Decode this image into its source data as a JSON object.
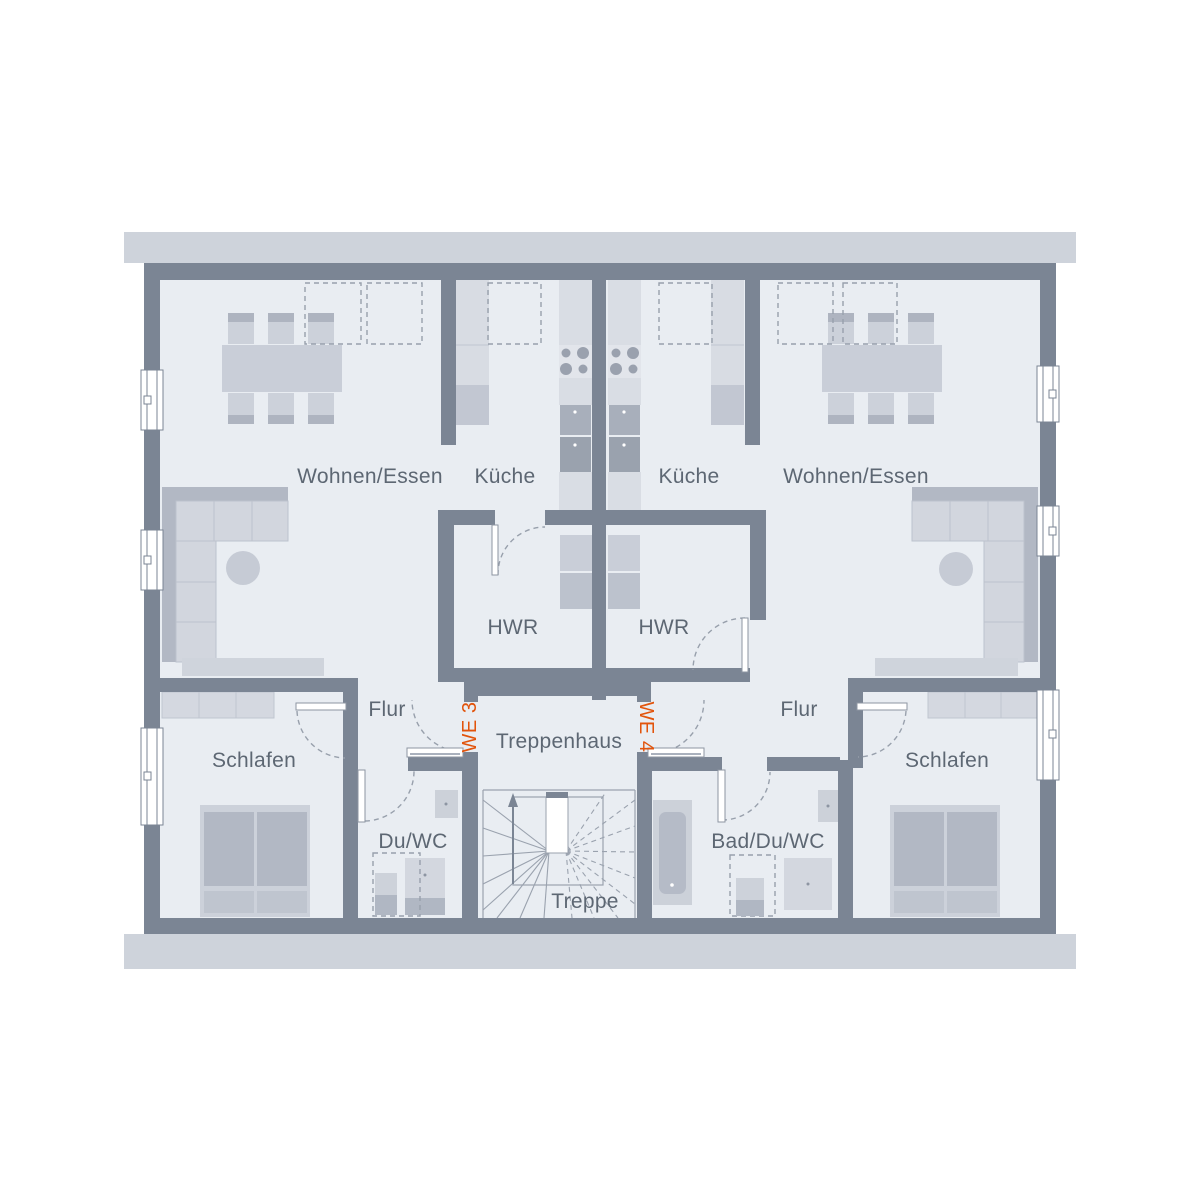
{
  "colors": {
    "wall": "#7b8594",
    "floor": "#e9edf2",
    "roof_band": "#ced3db",
    "furniture_light": "#d3d8e0",
    "furniture_mid": "#c4c9d4",
    "furniture_dark": "#b0b7c3",
    "appliance_dark": "#9aa2af",
    "dashed_symbol": "#98a0ac",
    "label_text": "#5d6773",
    "unit_accent": "#e2540c",
    "window_fill": "#ffffff"
  },
  "floorplan": {
    "units": {
      "we3": {
        "label": "WE 3"
      },
      "we4": {
        "label": "WE 4"
      }
    },
    "rooms": {
      "wohnen_left": {
        "label": "Wohnen/Essen"
      },
      "kueche_left": {
        "label": "Küche"
      },
      "kueche_right": {
        "label": "Küche"
      },
      "wohnen_right": {
        "label": "Wohnen/Essen"
      },
      "hwr_left": {
        "label": "HWR"
      },
      "hwr_right": {
        "label": "HWR"
      },
      "flur_left": {
        "label": "Flur"
      },
      "flur_right": {
        "label": "Flur"
      },
      "schlafen_left": {
        "label": "Schlafen"
      },
      "schlafen_right": {
        "label": "Schlafen"
      },
      "du_wc": {
        "label": "Du/WC"
      },
      "bad_du_wc": {
        "label": "Bad/Du/WC"
      },
      "treppenhaus": {
        "label": "Treppenhaus"
      },
      "treppe": {
        "label": "Treppe"
      }
    }
  }
}
